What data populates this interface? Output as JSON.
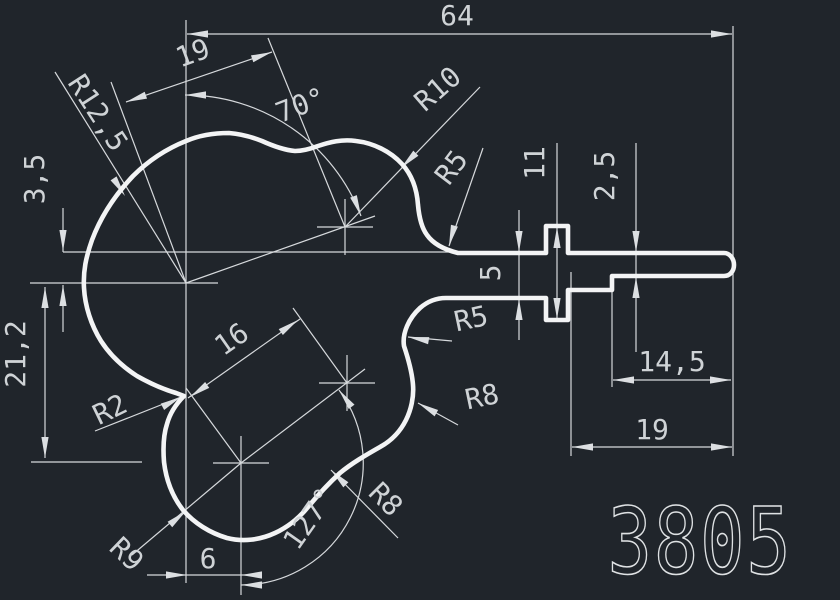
{
  "viewport": {
    "background_color": "#20252b",
    "profile_line_color": "#f3f4f5",
    "dimension_line_color": "#d6d9dc",
    "dimension_text_color": "#cfd3d6"
  },
  "title": {
    "part_number": "3805"
  },
  "dims": {
    "total_width": "64",
    "top_offset_19": "19",
    "angle_top": "70°",
    "r12_5": "R12,5",
    "r10": "R10",
    "r5_top": "R5",
    "tab_height_11": "11",
    "tail_thickness_2_5": "2,5",
    "offset_3_5": "3,5",
    "bar_thickness_5": "5",
    "height_21_2": "21,2",
    "step_width_14_5": "14,5",
    "right_width_19": "19",
    "r5_mid": "R5",
    "r8_mid": "R8",
    "r2": "R2",
    "center_distance_16": "16",
    "r8_low": "R8",
    "r9": "R9",
    "angle_low": "127°",
    "bottom_width_6": "6"
  }
}
